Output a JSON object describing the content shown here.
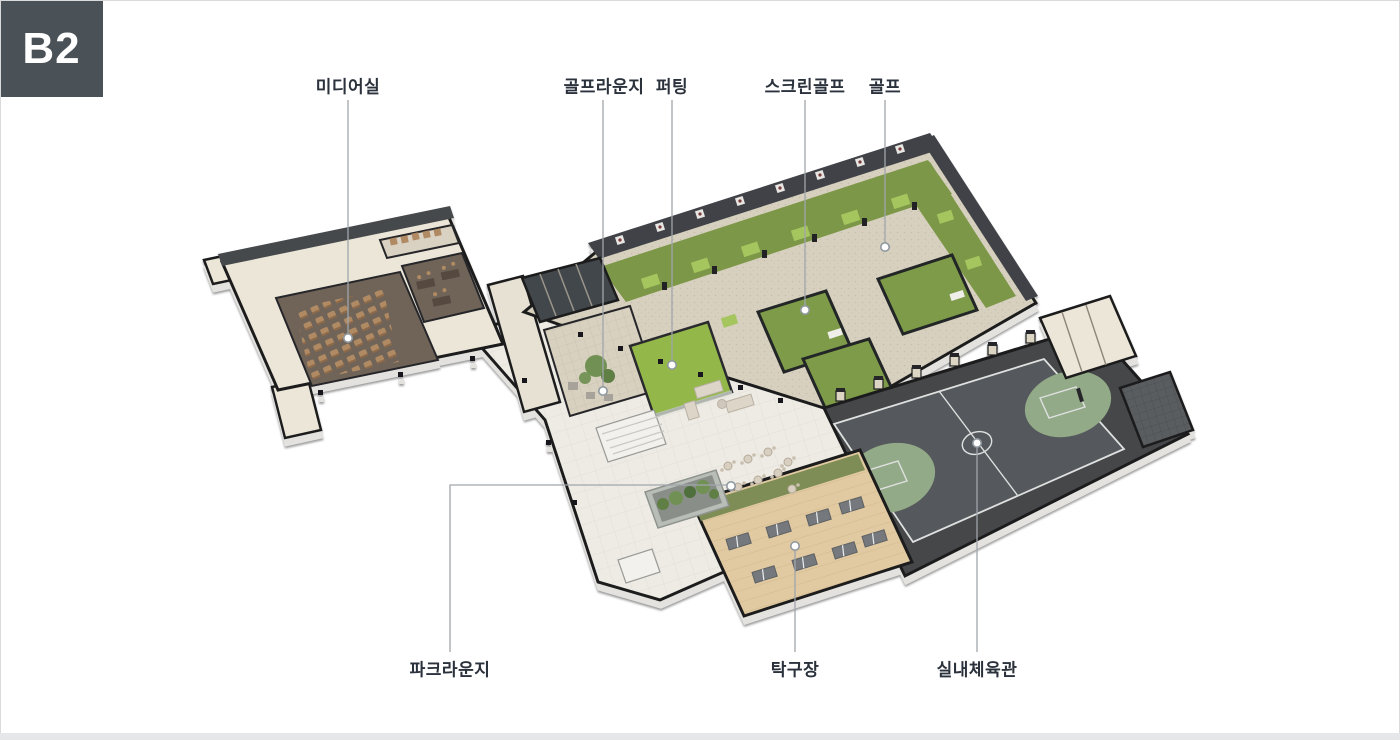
{
  "page": {
    "background": "#ffffff",
    "border_color": "#d8dadb",
    "bottom_bar_color": "#e5e7e8"
  },
  "badge": {
    "label": "B2",
    "background": "#4a5157",
    "text_color": "#ffffff"
  },
  "floorplan": {
    "kind": "isometric-basement-floor-plan",
    "labels": [
      {
        "id": "media-room",
        "text": "미디어실"
      },
      {
        "id": "golf-lounge",
        "text": "골프라운지"
      },
      {
        "id": "putting",
        "text": "퍼팅"
      },
      {
        "id": "screen-golf",
        "text": "스크린골프"
      },
      {
        "id": "golf",
        "text": "골프"
      },
      {
        "id": "park-lounge",
        "text": "파크라운지"
      },
      {
        "id": "table-tennis",
        "text": "탁구장"
      },
      {
        "id": "gym",
        "text": "실내체육관"
      }
    ],
    "colors": {
      "turf_green": "#7c9747",
      "putting_green": "#93b74a",
      "mat_green": "#a5c55e",
      "screen_room_green": "#7e9b48",
      "court_green": "#92aa87",
      "gym_floor": "#54585b",
      "wood_floor": "#e1caa2",
      "plaza_floor": "#edebe4",
      "hall_floor": "#d7d0bf",
      "wall_dark": "#1b1d1f",
      "wall_cream": "#ece6d8",
      "media_floor": "#6f6459",
      "seat_tan": "#b08a64",
      "label_text": "#2b323c",
      "leader_line": "#a0a6ab"
    }
  }
}
